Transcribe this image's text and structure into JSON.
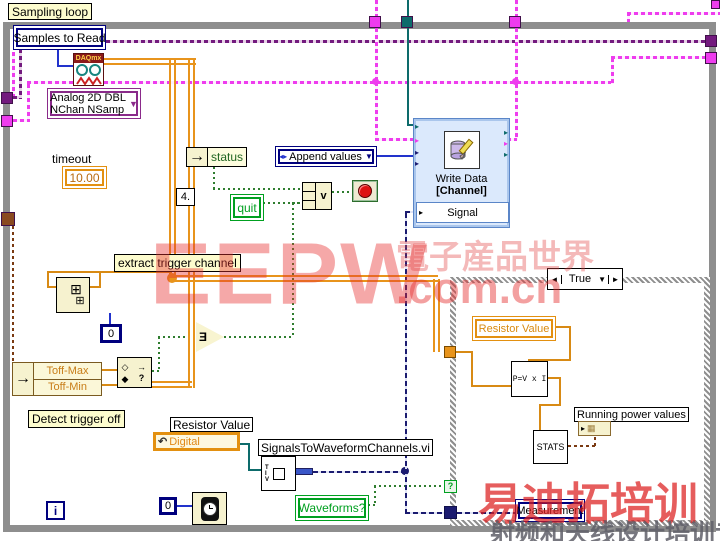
{
  "frame": {
    "loop_label": "Sampling loop"
  },
  "controls": {
    "samples_to_read": "Samples to Read",
    "timeout_label": "timeout",
    "timeout_value": "10.00",
    "selector_line1": "Analog 2D DBL",
    "selector_line2": "NChan NSamp",
    "status_label": "status",
    "append_values": "Append values",
    "quit": "quit",
    "const_4": "4.",
    "zero_index": "0",
    "zero_wait": "0",
    "iteration": "i",
    "toff_max": "Toff-Max",
    "toff_min": "Toff-Min",
    "resistor_value_label": "Resistor Value",
    "digital": "Digital",
    "waveforms": "Waveforms?"
  },
  "labels": {
    "extract_trigger": "extract trigger channel",
    "detect_trigger": "Detect trigger off",
    "subvi": "SignalsToWaveformChannels.vi"
  },
  "daq": {
    "header": "DAQmx"
  },
  "express": {
    "title1": "Write Data",
    "title2": "[Channel]",
    "signal": "Signal"
  },
  "case_structure": {
    "selector": "True",
    "prev": "◄",
    "next": "►",
    "dropdown": "▼",
    "selector_q": "?",
    "resistor_value": "Resistor Value",
    "formula": "P=V x I",
    "stats": "STATS",
    "running": "Running power values",
    "measurement": "Measurement"
  },
  "glyphs": {
    "enum_left": "◂▸",
    "dropdown": "▼",
    "arrow": "→",
    "or": "v",
    "any": "Ǝ",
    "in_range_top": "◇",
    "in_range_bottom": "◆",
    "in_range_q": "?",
    "grid_big": "⊞",
    "grid_small": "⊞",
    "mini_grid": "▦",
    "input_arrow": "▸"
  },
  "watermark": {
    "brand": "EEPW",
    "site_cn": "電子産品世界",
    "site": ".com.cn",
    "training": "易迪拓培训",
    "training_line": "射频和天线设计培训专家"
  },
  "colors": {
    "accent_orange": "#E8941C",
    "wire_pink": "#EE3CEE",
    "wire_teal": "#0D6B6B",
    "wire_navy": "#1B1B70",
    "loop_gray": "#8E8E8E",
    "stop_red": "#DD1111",
    "boolean_green": "#00A020"
  }
}
